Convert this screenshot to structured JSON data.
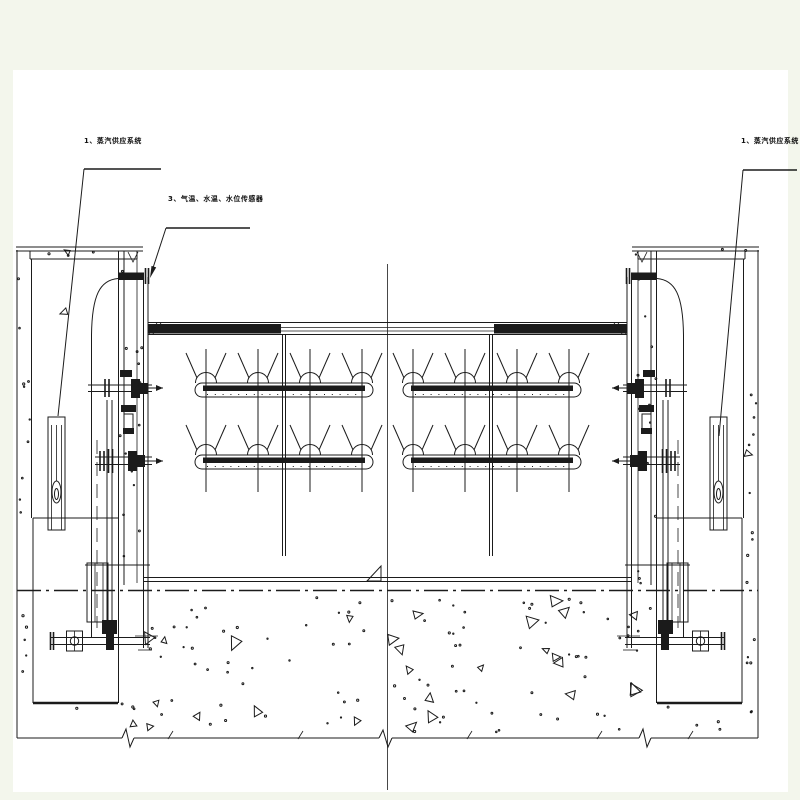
{
  "annotations": {
    "steam_supply_left": "1、蒸汽供应系统",
    "sensors": "3、气温、水温、水位传感器",
    "steam_supply_right": "1、蒸汽供应系统"
  },
  "colors": {
    "line": "#1b1b1b",
    "paper": "#ffffff",
    "margin": "#f3f6ec",
    "centerline": "#3a3a3a"
  }
}
